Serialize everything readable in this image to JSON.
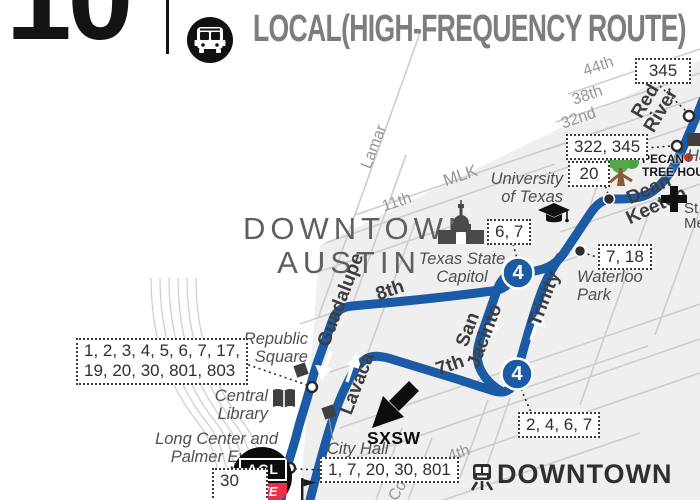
{
  "header": {
    "route_number": "10",
    "mode_label": "LOCAL(HIGH-FREQUENCY ROUTE)",
    "mode_icon": "bus-icon"
  },
  "area_labels": {
    "downtown_austin": "DOWNTOWN\nAUSTIN"
  },
  "streets": {
    "s44th": "44th",
    "s38th": "38th",
    "s32nd": "32nd",
    "s11th": "11th",
    "mlk": "MLK",
    "lamar": "Lamar",
    "s4th": "4th",
    "congress_partial": "Co",
    "s8th": "8th",
    "s7th": "7th",
    "red_river": "Red\nRiver",
    "dean_keeton": "Dean Keeton",
    "guadalupe": "Guadalupe",
    "lavaca": "Lavaca",
    "san_jacinto": "San\nJacinto",
    "trinity": "Trinity"
  },
  "pois": {
    "republic_square": "Republic\nSquare",
    "central_library": "Central\nLibrary",
    "city_hall": "City Hall",
    "waterloo_park": "Waterloo\nPark",
    "texas_capitol": "Texas State\nCapitol",
    "university": "University\nof Texas",
    "long_center": "Long Center and\nPalmer Events",
    "hancock_partial": "Ha",
    "medical_st": "St",
    "medical_me": "Me",
    "downtown_station": "DOWNTOWN",
    "sxsw": "SXSW",
    "pecan_line1": "PECAN",
    "pecan_line2": "TREE HOUSE",
    "acl_line1": "ACL",
    "acl_line2": "LiVE"
  },
  "route_boxes": {
    "b345": "345",
    "b322_345": "322, 345",
    "b20": "20",
    "b7_18": "7, 18",
    "b6_7": "6, 7",
    "b2_4_6_7": "2, 4, 6, 7",
    "republic_routes": "1, 2, 3, 4, 5, 6, 7, 17,\n19, 20, 30, 801, 803",
    "city_hall_routes": "1, 7, 20, 30, 801",
    "b30": "30"
  },
  "badges": {
    "route4": "4"
  },
  "colors": {
    "route_blue": "#1b5aa5",
    "acl_red": "#e8304a",
    "tree_green": "#4da344",
    "tree_trunk": "#8a5a33",
    "grid_gray": "#cdcdcd",
    "block_gray": "#efefef"
  }
}
